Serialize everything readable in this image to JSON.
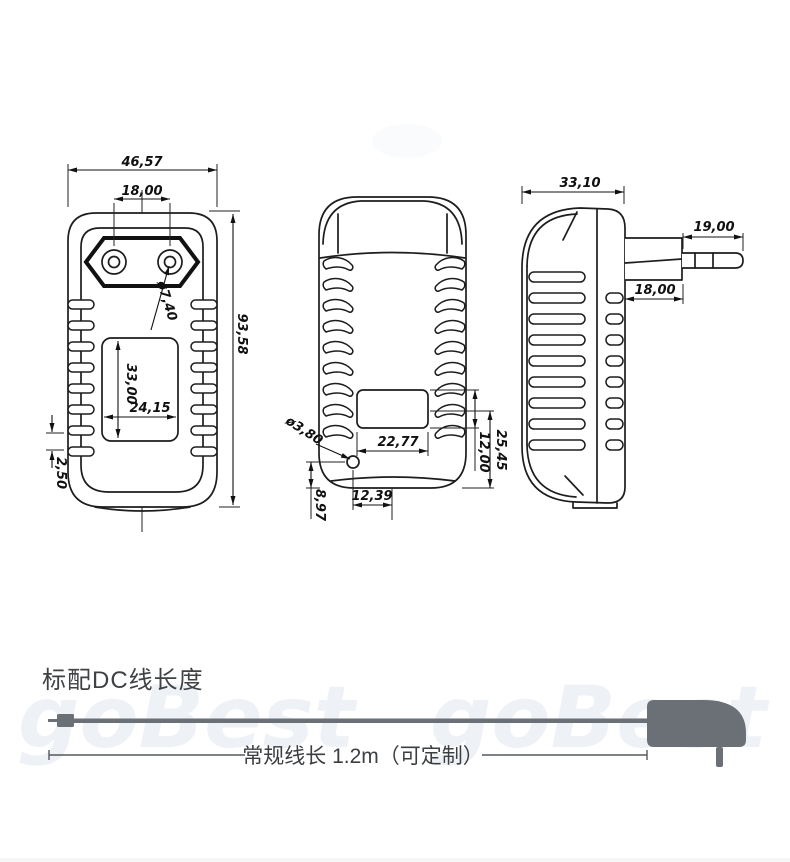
{
  "drawing": {
    "dims": {
      "front": {
        "overall_width": "46,57",
        "pin_spacing": "18,00",
        "pin_hole_dia": "ø7,40",
        "overall_height": "93,58",
        "recess_height": "33,00",
        "recess_width": "24,15",
        "bottom_gap": "2,50"
      },
      "back": {
        "hole_dia": "ø3,80",
        "recess_width": "22,77",
        "hole_offset_x": "12,39",
        "hole_offset_y": "8,97",
        "recess_height": "12,00",
        "recess_to_bottom": "25,45"
      },
      "side": {
        "depth": "33,10",
        "pin_length": "19,00",
        "plug_base_width": "18,00"
      }
    }
  },
  "cable_section": {
    "heading": "标配DC线长度",
    "length_note": "常规线长 1.2m（可定制）"
  },
  "watermark_text": "goBest",
  "colors": {
    "line_art": "#1d1d1d",
    "cable_gray": "#6b7076",
    "heading_text": "#3f4245"
  }
}
